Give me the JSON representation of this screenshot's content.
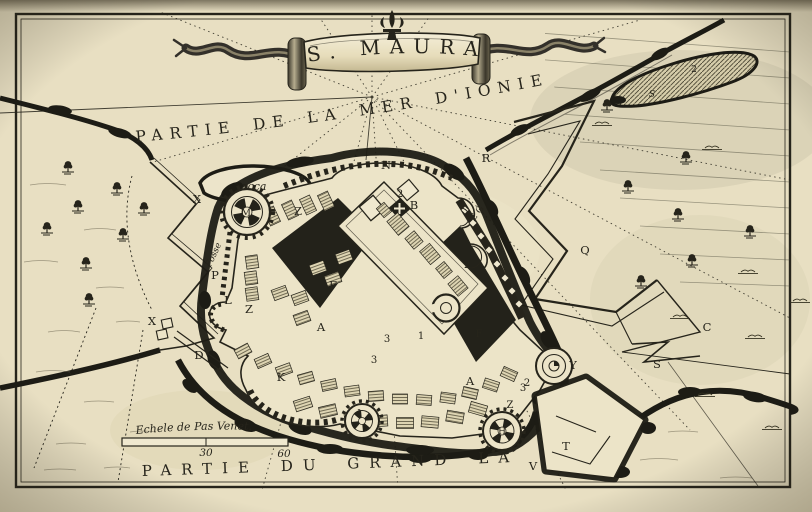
{
  "map": {
    "title": "S. MAURA",
    "sea_label": "PARTIE DE LA MER D'IONIE.",
    "lake_label": "PARTIE DU GRAND LAC.",
    "shoal_label": "Secca",
    "moat_label": "Fosse",
    "scale": {
      "label": "Echele de Pas Venet.",
      "ticks": [
        "30",
        "60"
      ]
    },
    "colors": {
      "paper": "#e8dfc2",
      "ink": "#26241b",
      "water_ink": "#1d1c15"
    },
    "labels": [
      {
        "t": "X",
        "x": 197,
        "y": 203
      },
      {
        "t": "X",
        "x": 152,
        "y": 325
      },
      {
        "t": "P",
        "x": 215,
        "y": 279
      },
      {
        "t": "L",
        "x": 228,
        "y": 304
      },
      {
        "t": "Z",
        "x": 249,
        "y": 313
      },
      {
        "t": "Z",
        "x": 298,
        "y": 215
      },
      {
        "t": "M",
        "x": 246,
        "y": 216,
        "s": 10
      },
      {
        "t": "N",
        "x": 386,
        "y": 169
      },
      {
        "t": "B",
        "x": 414,
        "y": 209
      },
      {
        "t": "2",
        "x": 400,
        "y": 197,
        "s": 10
      },
      {
        "t": "2",
        "x": 467,
        "y": 268,
        "s": 10
      },
      {
        "t": "F",
        "x": 333,
        "y": 289
      },
      {
        "t": "A",
        "x": 321,
        "y": 331
      },
      {
        "t": "A",
        "x": 470,
        "y": 385
      },
      {
        "t": "K",
        "x": 281,
        "y": 381
      },
      {
        "t": "D",
        "x": 199,
        "y": 359
      },
      {
        "t": "3",
        "x": 387,
        "y": 342,
        "s": 10
      },
      {
        "t": "3",
        "x": 374,
        "y": 363,
        "s": 10
      },
      {
        "t": "3",
        "x": 523,
        "y": 391,
        "s": 10
      },
      {
        "t": "1",
        "x": 421,
        "y": 339,
        "s": 10
      },
      {
        "t": "F",
        "x": 479,
        "y": 337,
        "s": 10
      },
      {
        "t": "I",
        "x": 359,
        "y": 416,
        "s": 9
      },
      {
        "t": "H",
        "x": 502,
        "y": 434,
        "s": 9
      },
      {
        "t": "Y",
        "x": 573,
        "y": 369
      },
      {
        "t": "Z",
        "x": 510,
        "y": 408,
        "s": 10
      },
      {
        "t": "2",
        "x": 527,
        "y": 386,
        "s": 10
      },
      {
        "t": "T",
        "x": 566,
        "y": 450
      },
      {
        "t": "V",
        "x": 533,
        "y": 470
      },
      {
        "t": "S",
        "x": 657,
        "y": 368
      },
      {
        "t": "C",
        "x": 707,
        "y": 331
      },
      {
        "t": "R",
        "x": 486,
        "y": 162
      },
      {
        "t": "Q",
        "x": 585,
        "y": 254
      },
      {
        "t": "E G",
        "x": 479,
        "y": 215,
        "r": -52,
        "s": 9
      },
      {
        "t": "2",
        "x": 694,
        "y": 72,
        "s": 9
      },
      {
        "t": "S",
        "x": 652,
        "y": 97,
        "s": 9,
        "i": true
      }
    ],
    "trees": [
      [
        68,
        172
      ],
      [
        117,
        193
      ],
      [
        78,
        211
      ],
      [
        144,
        213
      ],
      [
        47,
        233
      ],
      [
        123,
        239
      ],
      [
        86,
        268
      ],
      [
        89,
        304
      ],
      [
        607,
        110
      ],
      [
        686,
        162
      ],
      [
        628,
        191
      ],
      [
        678,
        219
      ],
      [
        692,
        265
      ],
      [
        641,
        286
      ],
      [
        750,
        236
      ]
    ],
    "grass": [
      [
        748,
        272
      ],
      [
        800,
        301
      ],
      [
        680,
        317
      ],
      [
        755,
        337
      ],
      [
        705,
        395
      ],
      [
        772,
        428
      ],
      [
        712,
        148
      ],
      [
        602,
        124
      ]
    ]
  }
}
